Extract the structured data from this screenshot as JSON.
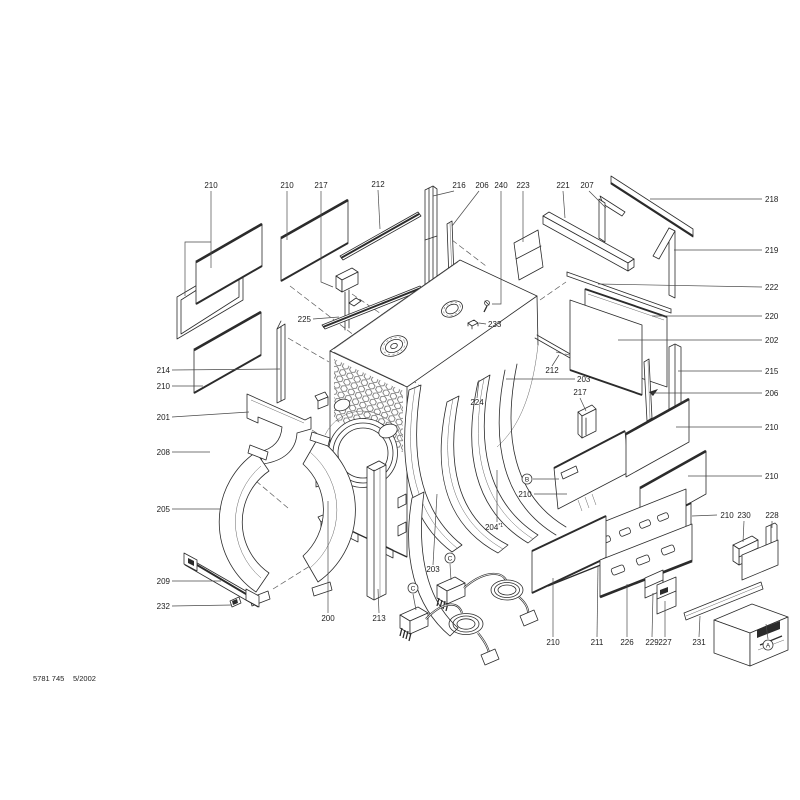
{
  "colors": {
    "ink": "#2b2b2b",
    "paper": "#ffffff"
  },
  "footer": {
    "doc_number": "5781 745",
    "date": "5/2002"
  },
  "diagram": {
    "labels": [
      {
        "text": "210",
        "x": 211,
        "y": 188,
        "anchor": "middle",
        "leaders": [
          [
            [
              211,
              191
            ],
            [
              211,
              268
            ]
          ],
          [
            [
              211,
              242
            ],
            [
              185,
              242
            ],
            [
              185,
              296
            ]
          ]
        ]
      },
      {
        "text": "210",
        "x": 287,
        "y": 188,
        "anchor": "middle",
        "leaders": [
          [
            [
              287,
              191
            ],
            [
              287,
              240
            ]
          ]
        ]
      },
      {
        "text": "217",
        "x": 321,
        "y": 188,
        "anchor": "middle",
        "leaders": [
          [
            [
              321,
              191
            ],
            [
              321,
              282
            ],
            [
              333,
              287
            ]
          ]
        ]
      },
      {
        "text": "212",
        "x": 378,
        "y": 187,
        "anchor": "middle",
        "leaders": [
          [
            [
              378,
              190
            ],
            [
              380,
              229
            ]
          ]
        ]
      },
      {
        "text": "216",
        "x": 459,
        "y": 188,
        "anchor": "middle",
        "leaders": [
          [
            [
              454,
              191
            ],
            [
              433,
              196
            ]
          ]
        ]
      },
      {
        "text": "206",
        "x": 482,
        "y": 188,
        "anchor": "middle",
        "leaders": [
          [
            [
              479,
              191
            ],
            [
              452,
              226
            ]
          ]
        ]
      },
      {
        "text": "240",
        "x": 501,
        "y": 188,
        "anchor": "middle",
        "leaders": [
          [
            [
              501,
              191
            ],
            [
              501,
              304
            ],
            [
              492,
              304
            ]
          ]
        ]
      },
      {
        "text": "223",
        "x": 523,
        "y": 188,
        "anchor": "middle",
        "leaders": [
          [
            [
              523,
              191
            ],
            [
              523,
              242
            ]
          ]
        ]
      },
      {
        "text": "221",
        "x": 563,
        "y": 188,
        "anchor": "middle",
        "leaders": [
          [
            [
              563,
              191
            ],
            [
              565,
              218
            ]
          ]
        ]
      },
      {
        "text": "207",
        "x": 587,
        "y": 188,
        "anchor": "middle",
        "leaders": [
          [
            [
              589,
              191
            ],
            [
              606,
              208
            ]
          ]
        ]
      },
      {
        "text": "218",
        "x": 765,
        "y": 202,
        "anchor": "start",
        "leaders": [
          [
            [
              762,
              199
            ],
            [
              650,
              199
            ]
          ]
        ]
      },
      {
        "text": "219",
        "x": 765,
        "y": 253,
        "anchor": "start",
        "leaders": [
          [
            [
              762,
              250
            ],
            [
              674,
              250
            ]
          ]
        ]
      },
      {
        "text": "222",
        "x": 765,
        "y": 290,
        "anchor": "start",
        "leaders": [
          [
            [
              762,
              287
            ],
            [
              598,
              284
            ]
          ]
        ]
      },
      {
        "text": "220",
        "x": 765,
        "y": 319,
        "anchor": "start",
        "leaders": [
          [
            [
              762,
              316
            ],
            [
              652,
              316
            ]
          ]
        ]
      },
      {
        "text": "202",
        "x": 765,
        "y": 343,
        "anchor": "start",
        "leaders": [
          [
            [
              762,
              340
            ],
            [
              618,
              340
            ]
          ]
        ]
      },
      {
        "text": "215",
        "x": 765,
        "y": 374,
        "anchor": "start",
        "leaders": [
          [
            [
              762,
              371
            ],
            [
              678,
              371
            ]
          ]
        ]
      },
      {
        "text": "206",
        "x": 765,
        "y": 396,
        "anchor": "start",
        "leaders": [
          [
            [
              762,
              393
            ],
            [
              652,
              393
            ]
          ]
        ]
      },
      {
        "text": "210",
        "x": 765,
        "y": 430,
        "anchor": "start",
        "leaders": [
          [
            [
              762,
              427
            ],
            [
              676,
              427
            ]
          ]
        ]
      },
      {
        "text": "210",
        "x": 765,
        "y": 479,
        "anchor": "start",
        "leaders": [
          [
            [
              762,
              476
            ],
            [
              688,
              476
            ]
          ]
        ]
      },
      {
        "text": "210",
        "x": 727,
        "y": 518,
        "anchor": "middle",
        "leaders": [
          [
            [
              717,
              515
            ],
            [
              692,
              516
            ]
          ]
        ]
      },
      {
        "text": "230",
        "x": 744,
        "y": 518,
        "anchor": "middle",
        "leaders": [
          [
            [
              744,
              521
            ],
            [
              743,
              542
            ]
          ]
        ]
      },
      {
        "text": "228",
        "x": 772,
        "y": 518,
        "anchor": "middle",
        "leaders": [
          [
            [
              772,
              521
            ],
            [
              772,
              528
            ]
          ]
        ]
      },
      {
        "text": "210",
        "x": 553,
        "y": 645,
        "anchor": "middle",
        "leaders": [
          [
            [
              553,
              637
            ],
            [
              553,
              578
            ]
          ]
        ]
      },
      {
        "text": "211",
        "x": 597,
        "y": 645,
        "anchor": "middle",
        "leaders": [
          [
            [
              597,
              637
            ],
            [
              598,
              566
            ]
          ]
        ]
      },
      {
        "text": "226",
        "x": 627,
        "y": 645,
        "anchor": "middle",
        "leaders": [
          [
            [
              627,
              637
            ],
            [
              627,
              584
            ]
          ]
        ]
      },
      {
        "text": "229",
        "x": 652,
        "y": 645,
        "anchor": "middle",
        "leaders": [
          [
            [
              652,
              637
            ],
            [
              653,
              593
            ]
          ]
        ]
      },
      {
        "text": "227",
        "x": 665,
        "y": 645,
        "anchor": "middle",
        "leaders": [
          [
            [
              665,
              637
            ],
            [
              665,
              601
            ]
          ]
        ]
      },
      {
        "text": "231",
        "x": 699,
        "y": 645,
        "anchor": "middle",
        "leaders": [
          [
            [
              699,
              637
            ],
            [
              700,
              616
            ]
          ]
        ]
      },
      {
        "text": "200",
        "x": 328,
        "y": 621,
        "anchor": "middle",
        "leaders": [
          [
            [
              328,
              613
            ],
            [
              328,
              501
            ]
          ]
        ]
      },
      {
        "text": "213",
        "x": 379,
        "y": 621,
        "anchor": "middle",
        "leaders": [
          [
            [
              379,
              613
            ],
            [
              378,
              589
            ]
          ]
        ]
      },
      {
        "text": "214",
        "x": 170,
        "y": 373,
        "anchor": "end",
        "leaders": [
          [
            [
              172,
              370
            ],
            [
              280,
              369
            ]
          ]
        ]
      },
      {
        "text": "210",
        "x": 170,
        "y": 389,
        "anchor": "end",
        "leaders": [
          [
            [
              172,
              386
            ],
            [
              203,
              386
            ]
          ]
        ]
      },
      {
        "text": "201",
        "x": 170,
        "y": 420,
        "anchor": "end",
        "leaders": [
          [
            [
              172,
              417
            ],
            [
              249,
              412
            ]
          ]
        ]
      },
      {
        "text": "208",
        "x": 170,
        "y": 455,
        "anchor": "end",
        "leaders": [
          [
            [
              172,
              452
            ],
            [
              210,
              452
            ]
          ]
        ]
      },
      {
        "text": "205",
        "x": 170,
        "y": 512,
        "anchor": "end",
        "leaders": [
          [
            [
              172,
              509
            ],
            [
              221,
              509
            ]
          ]
        ]
      },
      {
        "text": "209",
        "x": 170,
        "y": 584,
        "anchor": "end",
        "leaders": [
          [
            [
              172,
              581
            ],
            [
              221,
              581
            ]
          ]
        ]
      },
      {
        "text": "232",
        "x": 170,
        "y": 609,
        "anchor": "end",
        "leaders": [
          [
            [
              172,
              606
            ],
            [
              232,
              605
            ]
          ]
        ]
      },
      {
        "text": "225",
        "x": 311,
        "y": 322,
        "anchor": "end",
        "leaders": [
          [
            [
              313,
              319
            ],
            [
              339,
              317
            ]
          ]
        ]
      },
      {
        "text": "233",
        "x": 488,
        "y": 327,
        "anchor": "start",
        "leaders": [
          [
            [
              486,
              324
            ],
            [
              479,
              323
            ]
          ]
        ]
      },
      {
        "text": "224",
        "x": 477,
        "y": 405,
        "anchor": "middle",
        "leaders": [
          [
            [
              477,
              398
            ],
            [
              479,
              380
            ]
          ]
        ]
      },
      {
        "text": "212",
        "x": 552,
        "y": 373,
        "anchor": "middle",
        "leaders": [
          [
            [
              552,
              366
            ],
            [
              559,
              355
            ]
          ]
        ]
      },
      {
        "text": "203",
        "x": 577,
        "y": 382,
        "anchor": "start",
        "leaders": [
          [
            [
              575,
              379
            ],
            [
              506,
              379
            ]
          ]
        ]
      },
      {
        "text": "217",
        "x": 580,
        "y": 395,
        "anchor": "middle",
        "leaders": [
          [
            [
              580,
              398
            ],
            [
              586,
              411
            ]
          ]
        ]
      },
      {
        "text": "203",
        "x": 433,
        "y": 572,
        "anchor": "middle",
        "leaders": [
          [
            [
              433,
              565
            ],
            [
              437,
              494
            ]
          ]
        ]
      },
      {
        "text": "204",
        "sup": "*1",
        "x": 494,
        "y": 530,
        "anchor": "middle",
        "leaders": [
          [
            [
              497,
              522
            ],
            [
              497,
              470
            ]
          ]
        ]
      },
      {
        "text": "210",
        "x": 525,
        "y": 497,
        "anchor": "middle",
        "leaders": [
          [
            [
              534,
              494
            ],
            [
              567,
              494
            ]
          ]
        ]
      }
    ],
    "callouts": [
      {
        "letter": "A",
        "x": 768,
        "y": 645,
        "leaders": [
          [
            [
              768,
              639
            ],
            [
              766,
              624
            ]
          ]
        ]
      },
      {
        "letter": "B",
        "x": 527,
        "y": 479,
        "leaders": [
          [
            [
              533,
              479
            ],
            [
              559,
              479
            ]
          ]
        ]
      },
      {
        "letter": "C",
        "x": 450,
        "y": 558,
        "leaders": [
          [
            [
              450,
              564
            ],
            [
              451,
              580
            ]
          ]
        ]
      },
      {
        "letter": "C",
        "x": 413,
        "y": 588,
        "leaders": [
          [
            [
              413,
              594
            ],
            [
              416,
              610
            ]
          ]
        ]
      }
    ]
  }
}
